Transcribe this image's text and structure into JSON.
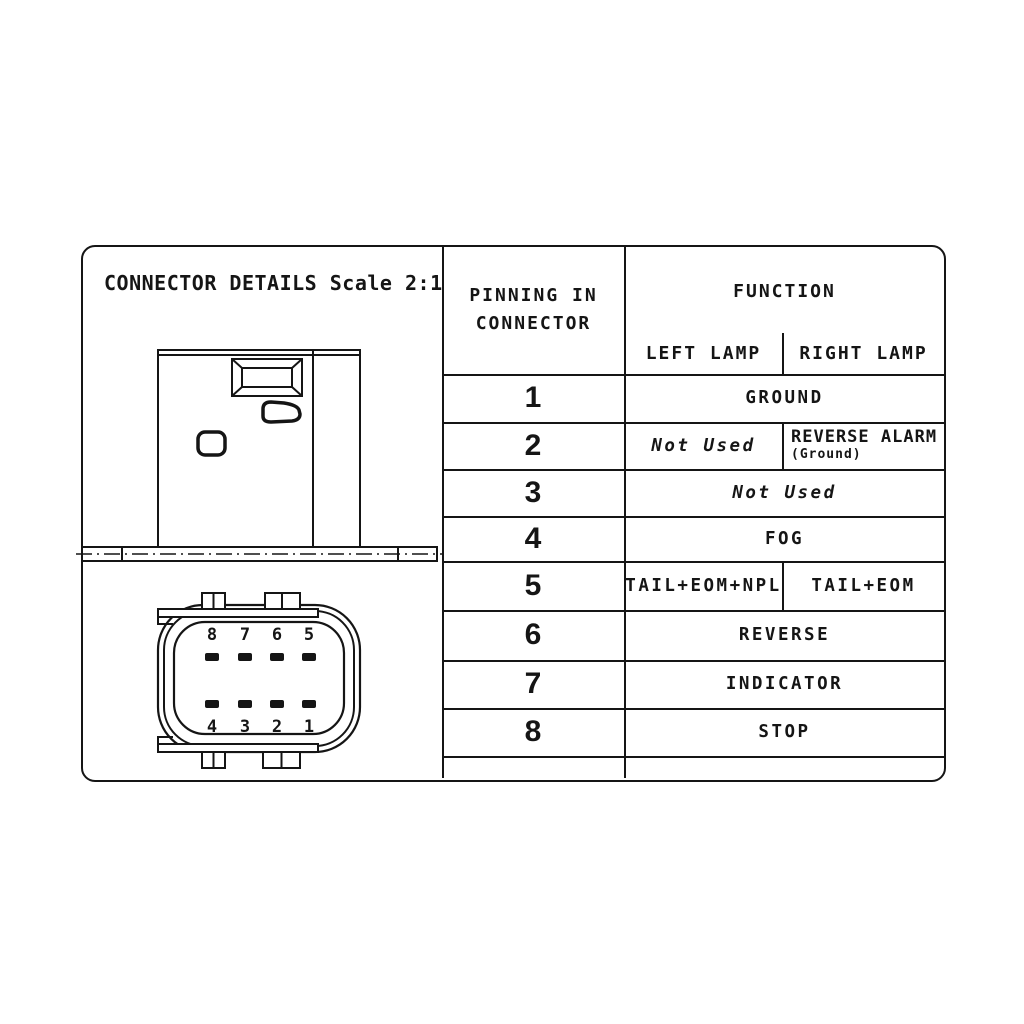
{
  "title": "CONNECTOR DETAILS Scale 2:1",
  "drawing": {
    "front_pins_top": [
      "8",
      "7",
      "6",
      "5"
    ],
    "front_pins_bottom": [
      "4",
      "3",
      "2",
      "1"
    ]
  },
  "table": {
    "header": {
      "pinning": "PINNING IN\nCONNECTOR",
      "function": "FUNCTION",
      "left_lamp": "LEFT LAMP",
      "right_lamp": "RIGHT LAMP"
    },
    "rows": [
      {
        "pin": "1",
        "function": "GROUND"
      },
      {
        "pin": "2",
        "left": "Not Used",
        "right": "REVERSE ALARM",
        "right_sub": "(Ground)"
      },
      {
        "pin": "3",
        "function": "Not Used"
      },
      {
        "pin": "4",
        "function": "FOG"
      },
      {
        "pin": "5",
        "left": "TAIL+EOM+NPL",
        "right": "TAIL+EOM"
      },
      {
        "pin": "6",
        "function": "REVERSE"
      },
      {
        "pin": "7",
        "function": "INDICATOR"
      },
      {
        "pin": "8",
        "function": "STOP"
      },
      {
        "pin": "",
        "function": ""
      }
    ]
  },
  "colors": {
    "line": "#151515",
    "background": "#ffffff"
  }
}
